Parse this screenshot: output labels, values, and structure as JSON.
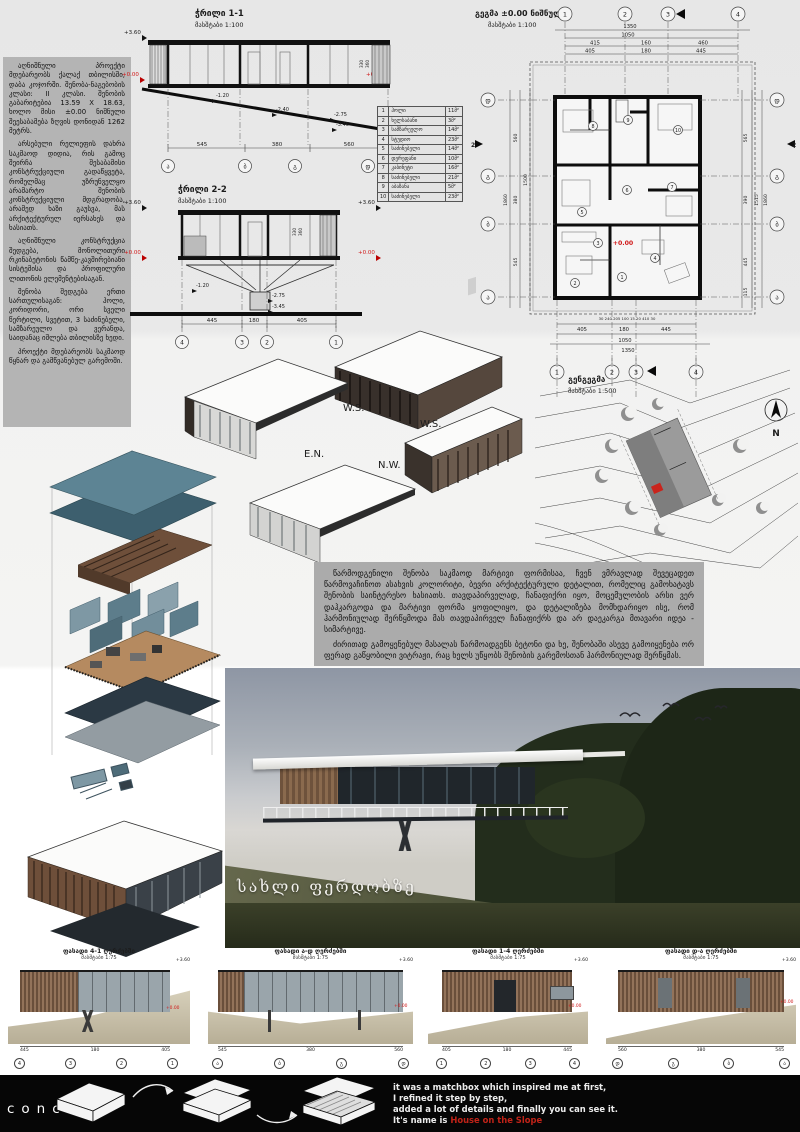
{
  "colors": {
    "accent_red": "#d01818",
    "teal_roof": "#54808f",
    "wood_brown": "#6e4f3a",
    "panel_gray": "#b4b4b4",
    "concept_bg": "#060606"
  },
  "left_text": {
    "p1": "აღნიშნული პროექტი მდებარეობს ქალაქ თბილისში, დაბა კოჯორში. შენობა-ნაგებობის კლასი: II კლასი. შენობის გაბარიტებია 13.59 X 18.63, ხოლო მისი ±0.00 ნიშნული შეესაბამება ზღვის დონიდან 1262 მეტრს.",
    "p2": "არსებული რელიეფის დახრა საკმაოდ დიდია, რის გამოც შეირჩა შესაბამისი კონსტრუქციული გადაწყვეტა, რომელმაც უზრუნველყო არამარტო შენობის კონსტრუქციული მდგრადობა, არამედ ხაზი გაუსვა, მას არქიტექტურულ იერსახეს და ხასიათს.",
    "p3": "აღნიშნული კონსტრუქცია შედგება, მონოლითური რკინაბეტონის წამწე-კავშირებიანი სისტემისა და პროფილური ლითონის ელემენტებისაგან.",
    "p4": "შენობა შედგება ერთი სართულისაგან: ჰოლი, კორიდორი, ორი სველი წერტილი, სვეტით, 3 საძინებელი, სამზარეულო და ვერანდა, საიდანაც იშლება თბილისზე ხედი.",
    "p5": "პროექტი მდებარეობს საკმაოდ წყნარ და გამწვანებულ გარემოში."
  },
  "center_text": {
    "p1": "წარმოდგენილი შენობა საკმაოდ მარტივი ფორმისაა, ჩვენ ვმრავლად შევეცადეთ წარმოვაჩინოთ ასახვის კოლორიტი, ბევრი არქიტექტურული დეტალით, რომელიც გამოხატავს შენობის საინტერესო ხასიათს. თავდაპირველად, ჩანაფიქრი იყო, მოცემულობის არსი ვერ დაჰკარგოდა და მარტივი ფორმა ყოფილიყო, და დეტალიზება მომხდარიყო ისე, რომ ჰარმონიულად შერწყმოდა მას თავდაპირველ ჩანაფიქრს და არ დაეკარგა მთავარი იდეა - სიმარტივე.",
    "p2": "ძირითად გამოყენებულ მასალას წარმოადგენს ბეტონი და ხე, შენობაში ასევე გამოიყენება ორ ფერად გაწყობილი ვიტრაჟი, რაც ხელს უწყობს შენობის გარემოსთან ჰარმონიულად შერწყმას."
  },
  "section1": {
    "title": "ჭრილი 1-1",
    "scale": "მასშტაბი 1:100",
    "lvl_top": "+3.60",
    "lvl_zero": "+0.00",
    "d1": "-1.20",
    "d2": "-2.40",
    "d3": "-2.75",
    "d4": "-3.45",
    "h1": "330",
    "h2": "360",
    "w1": "545",
    "w2": "380",
    "w3": "560",
    "a1": "ა",
    "a2": "ბ",
    "a3": "გ",
    "a4": "დ"
  },
  "section2": {
    "title": "ჭრილი 2-2",
    "scale": "მასშტაბი 1:100",
    "lvl_top": "+3.60",
    "lvl_zero": "+0.00",
    "d1": "-1.20",
    "d2": "-2.75",
    "d3": "-3.45",
    "h1": "330",
    "h2": "360",
    "w1": "445",
    "w2": "180",
    "w3": "405",
    "a1": "4",
    "a2": "3",
    "a3": "2",
    "a4": "1"
  },
  "room_table": {
    "rows": [
      {
        "n": "1",
        "name": "ჰოლი",
        "area": "11მ²"
      },
      {
        "n": "2",
        "name": "ხელსაბანი",
        "area": "3მ²"
      },
      {
        "n": "3",
        "name": "სამზარეულო",
        "area": "14მ²"
      },
      {
        "n": "4",
        "name": "სტუდიო",
        "area": "23მ²"
      },
      {
        "n": "5",
        "name": "საძინებელი",
        "area": "14მ²"
      },
      {
        "n": "6",
        "name": "დერეფანი",
        "area": "10მ²"
      },
      {
        "n": "7",
        "name": "კაბინეტი",
        "area": "16მ²"
      },
      {
        "n": "8",
        "name": "საძინებელი",
        "area": "21მ²"
      },
      {
        "n": "9",
        "name": "აბაზანა",
        "area": "5მ²"
      },
      {
        "n": "10",
        "name": "საძინებელი",
        "area": "23მ²"
      }
    ]
  },
  "plan": {
    "title": "გეგმა ±0.00 ნიშნულზე",
    "scale": "მასშტაბი 1:100",
    "level_zero": "+0.00",
    "cut": "2",
    "g": {
      "c1": "1",
      "c2": "2",
      "c3": "3",
      "c4": "4"
    },
    "rows": {
      "total": "1350",
      "inner": "1050",
      "t1": "415",
      "t2": "160",
      "t3": "460",
      "b1": "405",
      "b2": "180",
      "b3": "445"
    },
    "tiny": "30  240  205  100 15 20  410  30",
    "left": {
      "l1": "დ",
      "l2": "გ",
      "l3": "ბ",
      "l4": "ა",
      "s1": "560",
      "s2": "380",
      "s3": "545",
      "total": "1860",
      "inner": "1500"
    },
    "right": {
      "s1": "565",
      "s2": "390",
      "s3": "445",
      "s4": "115",
      "total": "1860",
      "inner": "1515"
    },
    "rooms": [
      "1",
      "2",
      "3",
      "4",
      "5",
      "6",
      "7",
      "8",
      "9",
      "10"
    ]
  },
  "siteplan": {
    "title": "გენგეგმა",
    "scale": "მასშტაბი 1:500",
    "north": "N"
  },
  "axons": {
    "l1": "W.S.",
    "l2": "W.S.",
    "l3": "E.N.",
    "l4": "N.W."
  },
  "photo": {
    "caption": "სახლი ფერდობზე"
  },
  "elevations": [
    {
      "title": "ფასადი 4-1 ღერძებში",
      "scale": "მასშტაბი 1:75",
      "level": "+3.60",
      "zero": "+0.00",
      "a1": "4",
      "a2": "3",
      "a3": "2",
      "a4": "1",
      "d1": "445",
      "d2": "180",
      "d3": "405"
    },
    {
      "title": "ფასადი ა-დ ღერძებში",
      "scale": "მასშტაბი 1:75",
      "level": "+3.60",
      "zero": "+0.00",
      "a1": "ა",
      "a2": "ბ",
      "a3": "გ",
      "a4": "დ",
      "d1": "545",
      "d2": "380",
      "d3": "560"
    },
    {
      "title": "ფასადი 1-4 ღერძებში",
      "scale": "მასშტაბი 1:75",
      "level": "+3.60",
      "zero": "+0.00",
      "a1": "1",
      "a2": "2",
      "a3": "3",
      "a4": "4",
      "d1": "405",
      "d2": "180",
      "d3": "445"
    },
    {
      "title": "ფასადი დ-ა ღერძებში",
      "scale": "მასშტაბი 1:75",
      "level": "+3.60",
      "zero": "+0.00",
      "a1": "დ",
      "a2": "გ",
      "a3": "ბ",
      "a4": "ა",
      "d1": "560",
      "d2": "380",
      "d3": "545"
    }
  ],
  "concept": {
    "label": "concept",
    "line1": "it was a matchbox which inspired me at first,",
    "line2": "I refined it step by step,",
    "line3": "added a lot of details and finally you can see it.",
    "line4": "It's name is",
    "highlight": "House on the Slope"
  }
}
